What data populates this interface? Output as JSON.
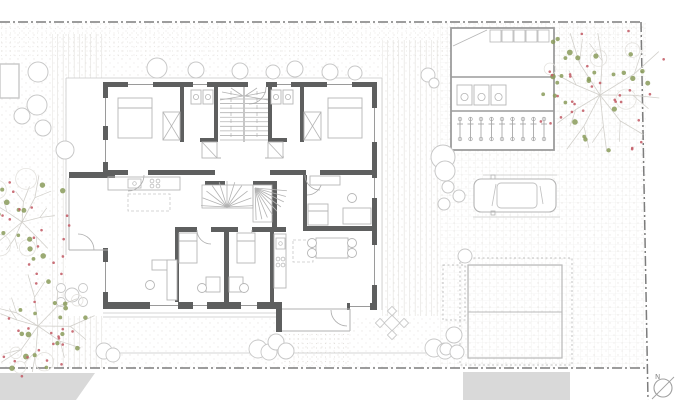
{
  "canvas": {
    "w": 677,
    "h": 400
  },
  "colors": {
    "bg": "#ffffff",
    "wall": "#5e5f5f",
    "window_line": "#9a9a9a",
    "thin": "#b2b2b2",
    "furn": "#b6b6b6",
    "lighter": "#c8c8c8",
    "boundary": "#7d7d7d",
    "road": "#d9d9d9",
    "grid": "#ebebe9",
    "hatch": "#e5e3e0",
    "stipple": "#d9d5cf",
    "branch": "#d2d0cb",
    "foliage": "#8a9b5a",
    "fruit": "#c4606a",
    "shelter": "#9c9c9c",
    "outline": "#bcbcbc",
    "north": "#a0a0a0"
  },
  "textures": {
    "stipple_region": [
      0,
      23,
      646,
      345
    ],
    "top_strip": [
      0,
      23,
      646,
      34
    ],
    "grid_region": [
      440,
      23,
      206,
      345
    ],
    "hatch_left": [
      52,
      34,
      51,
      334
    ],
    "hatch_right": [
      382,
      40,
      56,
      276
    ],
    "porch_paving": [
      283,
      333,
      67,
      33
    ]
  },
  "boundary": {
    "dash": "10 3 2 3",
    "segments": [
      [
        0,
        22,
        641,
        22
      ],
      [
        641,
        22,
        648,
        400
      ],
      [
        0,
        368,
        646,
        368
      ]
    ]
  },
  "roads": [
    {
      "name": "road-left",
      "pts": "0,373 95,373 76,400 0,400"
    },
    {
      "name": "road-center",
      "pts": "463,372 570,372 570,400 463,400"
    }
  ],
  "hedge": {
    "line": [
      104,
      353,
      445,
      353
    ],
    "bushes": [
      [
        104,
        351,
        8
      ],
      [
        113,
        355,
        7
      ],
      [
        258,
        349,
        9
      ],
      [
        269,
        352,
        8
      ],
      [
        434,
        348,
        9
      ],
      [
        445,
        351,
        8
      ]
    ]
  },
  "neighbor_building": [
    0,
    64,
    19,
    34
  ],
  "building": {
    "base": [
      66,
      78,
      316,
      238
    ],
    "porch_base": [
      276,
      302,
      76,
      32
    ],
    "overhang": [
      [
        66,
        78,
        382,
        78
      ],
      [
        382,
        78,
        382,
        310
      ],
      [
        66,
        78,
        66,
        255
      ]
    ],
    "terrace_lines": [
      [
        103,
        313,
        276,
        313
      ],
      [
        103,
        317,
        276,
        317
      ]
    ],
    "walls": [
      [
        103,
        82,
        145,
        5
      ],
      [
        266,
        82,
        111,
        5
      ],
      [
        372,
        82,
        5,
        228
      ],
      [
        103,
        302,
        179,
        7
      ],
      [
        347,
        303,
        30,
        7
      ],
      [
        103,
        82,
        5,
        90
      ],
      [
        69,
        172,
        46,
        6
      ],
      [
        103,
        248,
        5,
        61
      ],
      [
        276,
        302,
        6,
        30
      ],
      [
        180,
        87,
        4,
        55
      ],
      [
        214,
        87,
        4,
        55
      ],
      [
        268,
        87,
        4,
        55
      ],
      [
        300,
        87,
        4,
        55
      ],
      [
        200,
        138,
        18,
        4
      ],
      [
        268,
        138,
        19,
        4
      ],
      [
        108,
        170,
        20,
        5
      ],
      [
        148,
        170,
        67,
        5
      ],
      [
        270,
        170,
        36,
        5
      ],
      [
        320,
        170,
        57,
        5
      ],
      [
        303,
        175,
        4,
        52
      ],
      [
        303,
        226,
        74,
        5
      ],
      [
        224,
        227,
        5,
        75
      ],
      [
        175,
        227,
        4,
        75
      ],
      [
        270,
        227,
        4,
        75
      ],
      [
        175,
        227,
        22,
        5
      ],
      [
        211,
        227,
        27,
        5
      ],
      [
        252,
        227,
        34,
        5
      ],
      [
        272,
        183,
        5,
        44
      ],
      [
        205,
        181,
        20,
        4
      ],
      [
        253,
        181,
        24,
        4
      ]
    ],
    "windows_h": [
      [
        128,
        82,
        25,
        5
      ],
      [
        193,
        82,
        14,
        5
      ],
      [
        277,
        82,
        14,
        5
      ],
      [
        327,
        82,
        25,
        5
      ],
      [
        150,
        302,
        28,
        7
      ],
      [
        193,
        302,
        14,
        7
      ],
      [
        241,
        302,
        16,
        7
      ],
      [
        350,
        303,
        20,
        7
      ]
    ],
    "windows_v": [
      [
        103,
        98,
        5,
        28
      ],
      [
        103,
        140,
        5,
        22
      ],
      [
        103,
        262,
        5,
        30
      ],
      [
        372,
        108,
        5,
        34
      ],
      [
        372,
        178,
        5,
        20
      ],
      [
        372,
        245,
        5,
        40
      ]
    ],
    "bay_lines": [
      [
        69,
        178,
        69,
        250
      ],
      [
        69,
        250,
        108,
        250
      ]
    ],
    "porch_lines": [
      [
        282,
        309,
        350,
        309
      ],
      [
        350,
        309,
        350,
        331
      ],
      [
        282,
        331,
        350,
        331
      ]
    ],
    "hall_lines": [
      [
        214,
        158,
        221,
        158
      ],
      [
        265,
        158,
        272,
        158
      ]
    ],
    "stairs": {
      "divider": [
        244,
        87,
        244,
        142
      ],
      "flights": [
        {
          "x1": 220,
          "x2": 243,
          "y1": 99,
          "y2": 140,
          "n": 10
        },
        {
          "x1": 245,
          "x2": 268,
          "y1": 99,
          "y2": 140,
          "n": 10
        }
      ],
      "winders": [
        [
          243,
          96,
          220,
          100
        ],
        [
          243,
          96,
          222,
          92
        ],
        [
          243,
          96,
          231,
          88
        ],
        [
          245,
          96,
          268,
          100
        ],
        [
          245,
          96,
          266,
          92
        ],
        [
          245,
          96,
          257,
          88
        ]
      ],
      "walklines": [
        [
          231,
          91,
          231,
          138
        ],
        [
          257,
          91,
          257,
          138
        ]
      ],
      "fans": [
        {
          "px": 227,
          "py": 207,
          "r": 26,
          "a1": 183,
          "a2": 357,
          "n": 10,
          "box": [
            202,
            185,
            51,
            23
          ]
        },
        {
          "px": 255,
          "py": 188,
          "r": 32,
          "a1": 5,
          "a2": 88,
          "n": 8,
          "box": [
            253,
            185,
            19,
            37
          ]
        }
      ]
    },
    "doors": [
      {
        "px": 249,
        "py": 87,
        "r": 17,
        "a1": 0,
        "a2": 90
      },
      {
        "px": 128,
        "py": 175,
        "r": 16,
        "a1": 0,
        "a2": 90
      },
      {
        "px": 320,
        "py": 175,
        "r": 15,
        "a1": 90,
        "a2": 180
      },
      {
        "px": 78,
        "py": 250,
        "r": 16,
        "a1": 270,
        "a2": 360
      },
      {
        "px": 347,
        "py": 310,
        "r": 16,
        "a1": 90,
        "a2": 180
      },
      {
        "px": 211,
        "py": 230,
        "r": 14,
        "a1": 90,
        "a2": 180
      },
      {
        "px": 238,
        "py": 230,
        "r": 14,
        "a1": 0,
        "a2": 90
      },
      {
        "px": 202,
        "py": 142,
        "r": 15,
        "a1": 0,
        "a2": 90
      },
      {
        "px": 284,
        "py": 142,
        "r": 15,
        "a1": 90,
        "a2": 180
      },
      {
        "px": 307,
        "py": 180,
        "r": 15,
        "a1": 0,
        "a2": 90
      }
    ],
    "furniture": {
      "beds": [
        [
          118,
          98,
          34,
          40,
          108
        ],
        [
          328,
          98,
          34,
          40,
          108
        ],
        [
          179,
          233,
          18,
          30,
          241
        ],
        [
          237,
          233,
          18,
          30,
          241
        ],
        [
          308,
          204,
          20,
          21,
          211
        ]
      ],
      "wardrobes": [
        [
          163,
          112,
          17,
          28
        ],
        [
          304,
          112,
          17,
          28
        ]
      ],
      "closets": [
        [
          202,
          142,
          15,
          16
        ],
        [
          268,
          142,
          15,
          16
        ]
      ],
      "washers": [
        [
          191,
          90,
          10,
          14
        ],
        [
          203,
          90,
          10,
          14
        ],
        [
          271,
          90,
          10,
          14
        ],
        [
          283,
          90,
          10,
          14
        ]
      ],
      "counters": [
        [
          108,
          177,
          72,
          13
        ],
        [
          274,
          234,
          12,
          54
        ]
      ],
      "sinks": [
        [
          128,
          179,
          13,
          9
        ],
        [
          276,
          238,
          9,
          11
        ]
      ],
      "hobs": [
        [
          152,
          181
        ],
        [
          158,
          181
        ],
        [
          152,
          186
        ],
        [
          158,
          186
        ],
        [
          278,
          259
        ],
        [
          283,
          259
        ],
        [
          278,
          265
        ],
        [
          283,
          265
        ]
      ],
      "dashed_rects": [
        [
          128,
          194,
          42,
          17
        ],
        [
          293,
          240,
          20,
          22
        ]
      ],
      "tables": [
        [
          316,
          238,
          32,
          20
        ]
      ],
      "desks": [
        [
          152,
          260,
          25,
          10
        ],
        [
          167,
          260,
          10,
          40
        ],
        [
          206,
          277,
          14,
          15
        ],
        [
          229,
          277,
          14,
          15
        ],
        [
          343,
          208,
          28,
          16
        ],
        [
          310,
          176,
          30,
          9
        ]
      ],
      "chairs": [
        [
          312,
          243
        ],
        [
          312,
          253
        ],
        [
          352,
          243
        ],
        [
          352,
          253
        ],
        [
          150,
          285
        ],
        [
          202,
          288
        ],
        [
          244,
          288
        ],
        [
          352,
          198
        ]
      ]
    }
  },
  "shelter": {
    "frame": [
      451,
      28,
      103,
      122
    ],
    "hwalls": [
      [
        451,
        77,
        554,
        77
      ],
      [
        451,
        111,
        554,
        111
      ]
    ],
    "roof_rects": [
      [
        490,
        30,
        11,
        12
      ],
      [
        502,
        30,
        11,
        12
      ],
      [
        514,
        30,
        11,
        12
      ],
      [
        526,
        30,
        11,
        12
      ],
      [
        538,
        30,
        11,
        12
      ]
    ],
    "door_diag": [
      453,
      46,
      487,
      30
    ],
    "washers": [
      [
        457,
        85,
        15,
        20
      ],
      [
        474,
        85,
        15,
        20
      ],
      [
        491,
        85,
        15,
        20
      ]
    ],
    "bikes": {
      "x0": 460,
      "dx": 10.5,
      "n": 9,
      "y1": 117,
      "y2": 141
    }
  },
  "garage": {
    "solid": [
      468,
      265,
      94,
      93
    ],
    "mid": [
      468,
      312,
      562,
      312
    ],
    "dotted": [
      460,
      258,
      112,
      107
    ],
    "small_dotted": [
      443,
      265,
      22,
      55
    ]
  },
  "car": {
    "body": [
      474,
      179,
      82,
      33
    ],
    "cabin": [
      497,
      183,
      40,
      25
    ],
    "lines": [
      [
        496,
        184,
        492,
        206
      ],
      [
        540,
        186,
        543,
        204
      ]
    ],
    "mirrors": [
      [
        491,
        175,
        4,
        4
      ],
      [
        491,
        211,
        4,
        4
      ]
    ],
    "guides": [
      [
        483,
        175,
        557,
        175
      ],
      [
        473,
        217,
        560,
        217
      ]
    ]
  },
  "outdoor_tables": [
    {
      "cx": 72,
      "cy": 295,
      "style": "round"
    },
    {
      "cx": 392,
      "cy": 323,
      "style": "square"
    }
  ],
  "trees": [
    {
      "cx": 600,
      "cy": 95,
      "r": 78,
      "branches": 9,
      "leaves": 26,
      "fruits": 28,
      "seed": 11
    },
    {
      "cx": 22,
      "cy": 222,
      "r": 58,
      "branches": 7,
      "leaves": 16,
      "fruits": 20,
      "seed": 23
    },
    {
      "cx": 38,
      "cy": 326,
      "r": 62,
      "branches": 8,
      "leaves": 18,
      "fruits": 22,
      "seed": 37
    }
  ],
  "bushes": [
    [
      38,
      72,
      10
    ],
    [
      37,
      105,
      10
    ],
    [
      22,
      116,
      8
    ],
    [
      43,
      128,
      8
    ],
    [
      65,
      150,
      9
    ],
    [
      157,
      68,
      10
    ],
    [
      196,
      70,
      8
    ],
    [
      240,
      71,
      8
    ],
    [
      273,
      72,
      7
    ],
    [
      295,
      69,
      8
    ],
    [
      330,
      72,
      8
    ],
    [
      355,
      73,
      7
    ],
    [
      428,
      75,
      7
    ],
    [
      434,
      83,
      5
    ],
    [
      443,
      157,
      12
    ],
    [
      445,
      171,
      10
    ],
    [
      448,
      187,
      6
    ],
    [
      459,
      196,
      6
    ],
    [
      444,
      204,
      6
    ],
    [
      465,
      256,
      7
    ],
    [
      454,
      335,
      8
    ],
    [
      446,
      349,
      6
    ],
    [
      457,
      352,
      7
    ],
    [
      276,
      342,
      8
    ],
    [
      286,
      351,
      8
    ]
  ],
  "north": {
    "cx": 663,
    "cy": 388,
    "r": 9,
    "needle": [
      652,
      399,
      674,
      377
    ],
    "label": "N",
    "lx": 655,
    "ly": 379
  }
}
